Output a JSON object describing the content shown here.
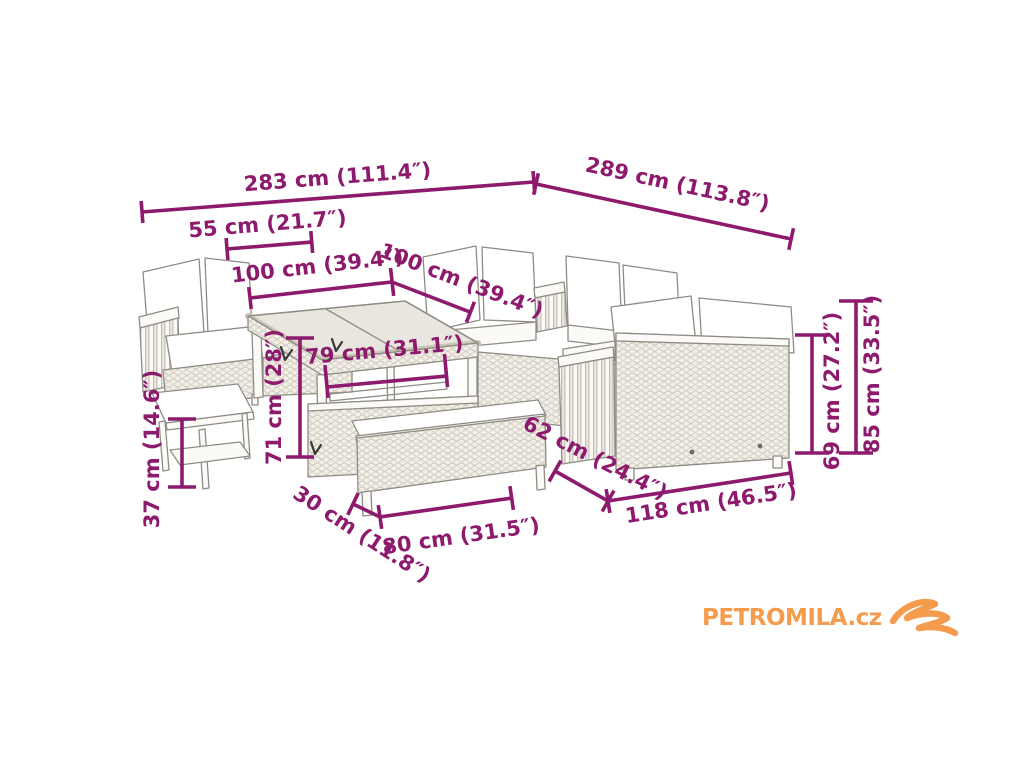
{
  "colors": {
    "dim_accent": "#8D1A6D",
    "logo_orange": "#F59B4D",
    "line_gray": "#8F8C84"
  },
  "logo": {
    "text": "PETROMILA.cz",
    "icon": "logo-swoosh-icon"
  },
  "dimensions": [
    {
      "id": "total-width",
      "label": "283 cm (111.4″)"
    },
    {
      "id": "total-depth",
      "label": "289 cm (113.8″)"
    },
    {
      "id": "stool-width",
      "label": "55 cm (21.7″)"
    },
    {
      "id": "left-module-width",
      "label": "100 cm (39.4″)"
    },
    {
      "id": "back-module-width",
      "label": "100 cm (39.4″)"
    },
    {
      "id": "table-width",
      "label": "79 cm (31.1″)"
    },
    {
      "id": "table-height",
      "label": "71 cm (28″)"
    },
    {
      "id": "stool-height",
      "label": "37 cm (14.6″)"
    },
    {
      "id": "sofa-depth",
      "label": "62 cm (24.4″)"
    },
    {
      "id": "bench-depth",
      "label": "30 cm (11.8″)"
    },
    {
      "id": "bench-width",
      "label": "80 cm (31.5″)"
    },
    {
      "id": "sofa-width",
      "label": "118 cm (46.5″)"
    },
    {
      "id": "backrest-height",
      "label": "69 cm (27.2″)"
    },
    {
      "id": "total-height",
      "label": "85 cm (33.5″)"
    }
  ]
}
